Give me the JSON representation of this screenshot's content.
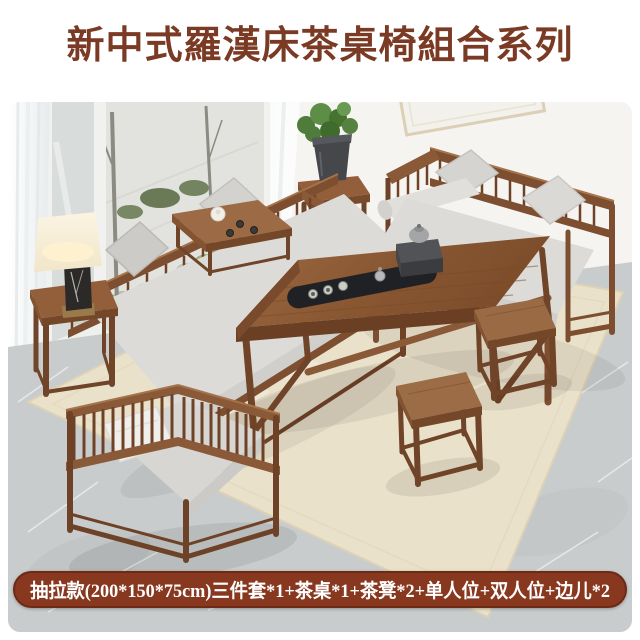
{
  "header": {
    "title": "新中式羅漢床茶桌椅組合系列"
  },
  "banner": {
    "text": "抽拉款(200*150*75cm)三件套*1+茶桌*1+茶凳*2+单人位+双人位+边儿*2"
  },
  "colors": {
    "title_text": "#7a3a24",
    "banner_background": "#87381f",
    "banner_border": "#6e2a15",
    "banner_text": "#ffffff",
    "wood": "#8a5a38",
    "wood_dark": "#6e4227",
    "cushion_gray": "#d8d7d4",
    "pillow_white": "#f0efeb",
    "rug_beige": "#eae1ca",
    "floor_marble": "#c9cccd",
    "wall_white": "#f6f4f1",
    "moss_green": "#8fa75e",
    "tea_tray_black": "#202124"
  },
  "scene": {
    "items": [
      "window-garden",
      "curtains",
      "wall-art",
      "plant-stand",
      "daybed-sofa",
      "kang-table",
      "loveseat-sofa",
      "tea-table",
      "tea-tray-set",
      "tea-stool-far",
      "tea-stool-near",
      "armchair",
      "side-table",
      "table-lamp",
      "rug",
      "marble-floor"
    ]
  }
}
